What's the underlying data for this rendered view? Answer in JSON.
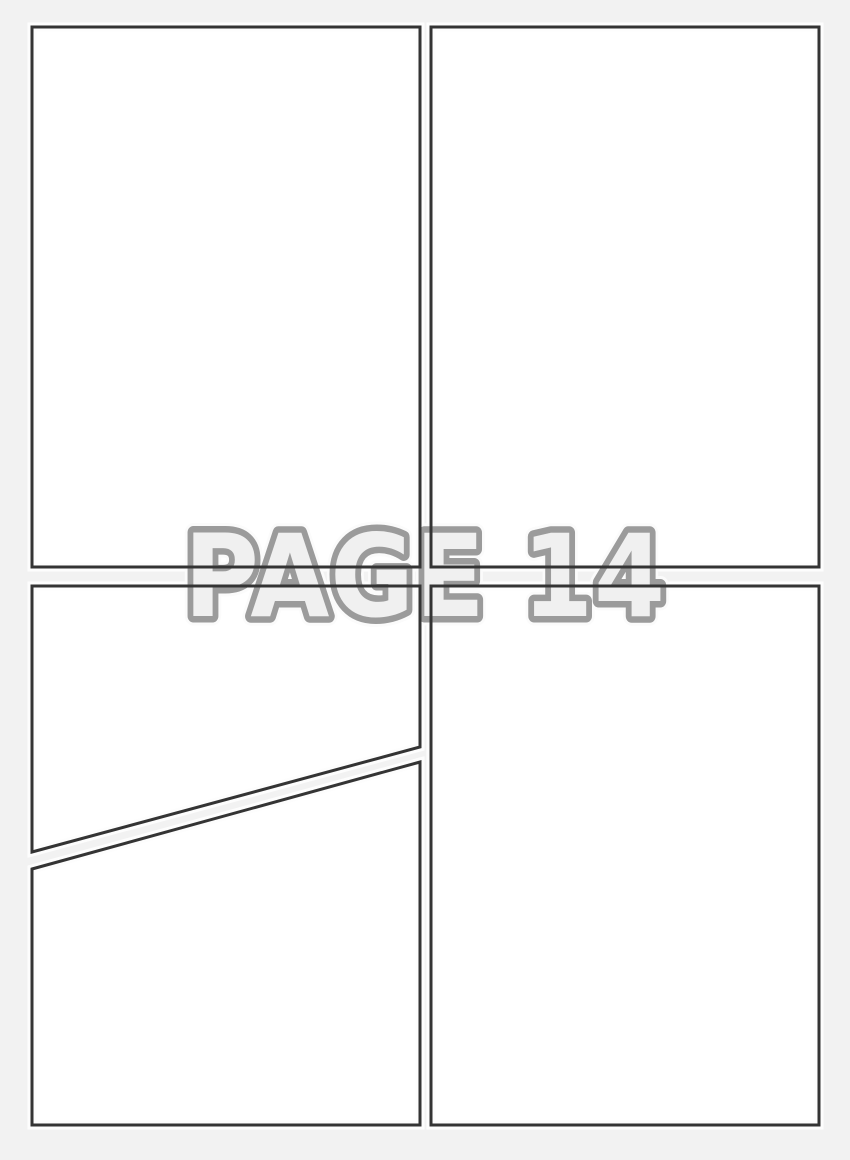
{
  "document": {
    "type_label": "comic-page-template",
    "watermark": {
      "text": "PAGE 14"
    },
    "panels": [
      {
        "id": "panel-1",
        "position": "top-left"
      },
      {
        "id": "panel-2",
        "position": "top-right"
      },
      {
        "id": "panel-3",
        "position": "middle-left-diagonal-top"
      },
      {
        "id": "panel-4",
        "position": "bottom-left-diagonal-bottom"
      },
      {
        "id": "panel-5",
        "position": "bottom-right"
      }
    ]
  },
  "colors": {
    "background": "#f2f2f2",
    "panel_fill": "#ffffff",
    "panel_halo": "#fdfdfd",
    "border": "#343434",
    "watermark_fill": "#f0f0f0",
    "watermark_outline": "#9b9b9b",
    "watermark_halo": "#fbfbfb"
  }
}
